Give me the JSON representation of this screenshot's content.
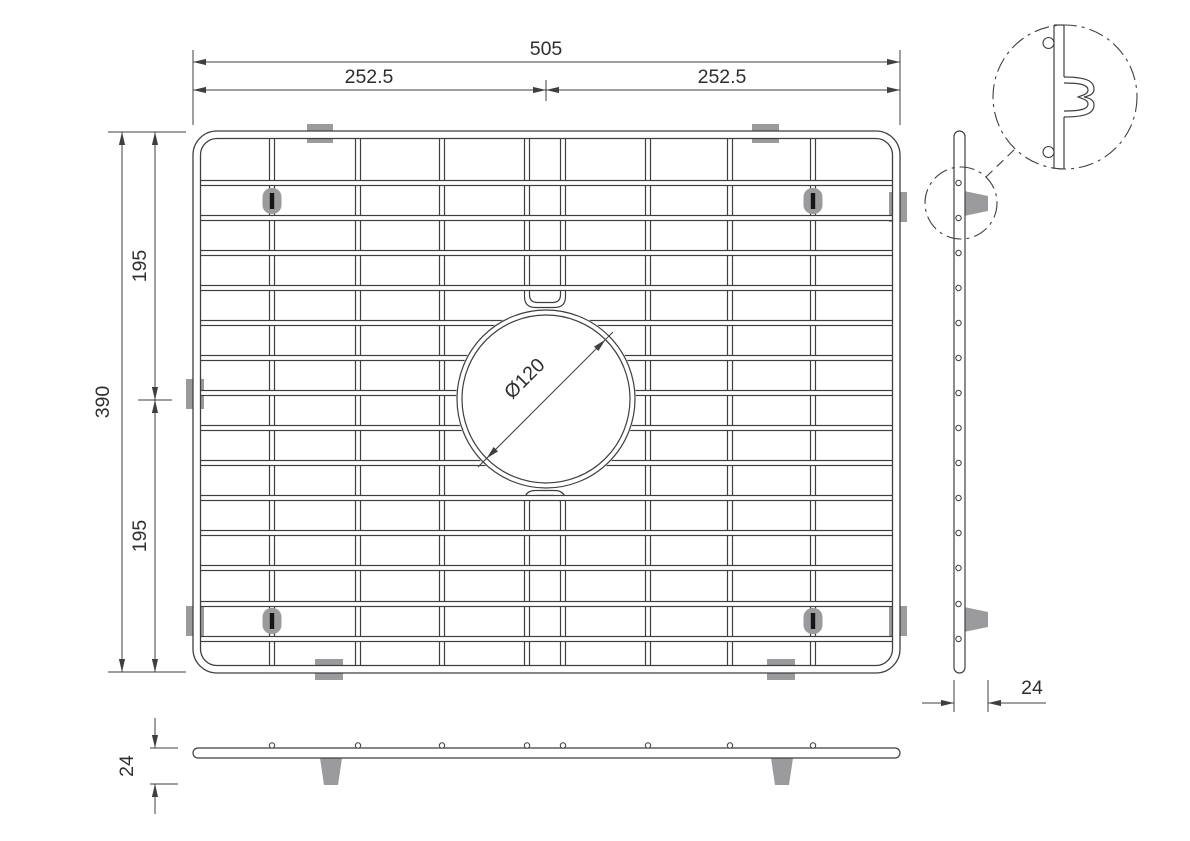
{
  "title": "Sink bottom-grid technical drawing",
  "drawing": {
    "dimensions": {
      "total_width": "505",
      "half_width_left": "252.5",
      "half_width_right": "252.5",
      "total_height": "390",
      "half_height_top": "195",
      "half_height_bottom": "195",
      "hole_diameter": "Ø120",
      "side_profile_depth": "24",
      "front_profile_height": "24"
    },
    "colors": {
      "line": "#3f3f3f",
      "text": "#2e2e2e",
      "pad_gray": "#9b9b9e",
      "slot_black": "#161616",
      "background": "#ffffff"
    },
    "main_view": {
      "frame": {
        "x": 193,
        "y": 131,
        "w": 707,
        "h": 542,
        "rx": 24,
        "tube": 7.5
      },
      "vertical_wires_x": [
        272,
        358,
        442,
        527,
        563,
        648,
        730,
        813
      ],
      "hairpin_pair_x": [
        527,
        563
      ],
      "horizontal_wires_y": [
        183,
        218,
        253,
        288,
        323,
        358,
        393,
        428,
        463,
        498,
        533,
        568,
        604,
        639
      ],
      "hole": {
        "cx": 546,
        "cy": 399,
        "r_outer": 89,
        "r_inner": 84
      },
      "edge_pads": [
        {
          "x": 307,
          "y": 124,
          "w": 26,
          "h": 19
        },
        {
          "x": 752,
          "y": 124,
          "w": 27,
          "h": 19
        },
        {
          "x": 315,
          "y": 659,
          "w": 28,
          "h": 21
        },
        {
          "x": 767,
          "y": 659,
          "w": 28,
          "h": 21
        },
        {
          "x": 186,
          "y": 379,
          "w": 18,
          "h": 30
        },
        {
          "x": 186,
          "y": 606,
          "w": 18,
          "h": 30
        },
        {
          "x": 889,
          "y": 192,
          "w": 18,
          "h": 30
        },
        {
          "x": 889,
          "y": 606,
          "w": 18,
          "h": 30
        }
      ],
      "fasteners": [
        {
          "x": 272,
          "cy": 201
        },
        {
          "x": 813,
          "cy": 201
        },
        {
          "x": 272,
          "cy": 621
        },
        {
          "x": 813,
          "cy": 621
        }
      ]
    },
    "side_view": {
      "strip": {
        "x": 954,
        "y": 131,
        "w": 11,
        "h": 542,
        "rx": 5.5
      },
      "wire_dot_x": 958.5,
      "feet": [
        {
          "y1": 191,
          "y2": 216
        },
        {
          "y1": 607,
          "y2": 632
        }
      ],
      "foot_tip_x": 988,
      "detail_small": {
        "cx": 961,
        "cy": 203,
        "r": 36
      },
      "detail_big": {
        "cx": 1065,
        "cy": 97,
        "r": 72
      }
    },
    "front_view": {
      "strip": {
        "x": 193,
        "y": 748,
        "w": 707,
        "h": 10,
        "rx": 5
      },
      "dot_y": 745.5,
      "feet_cx": [
        331,
        782
      ],
      "foot": {
        "top_w": 22,
        "bot_w": 14,
        "y1": 758,
        "y2": 785
      }
    }
  }
}
